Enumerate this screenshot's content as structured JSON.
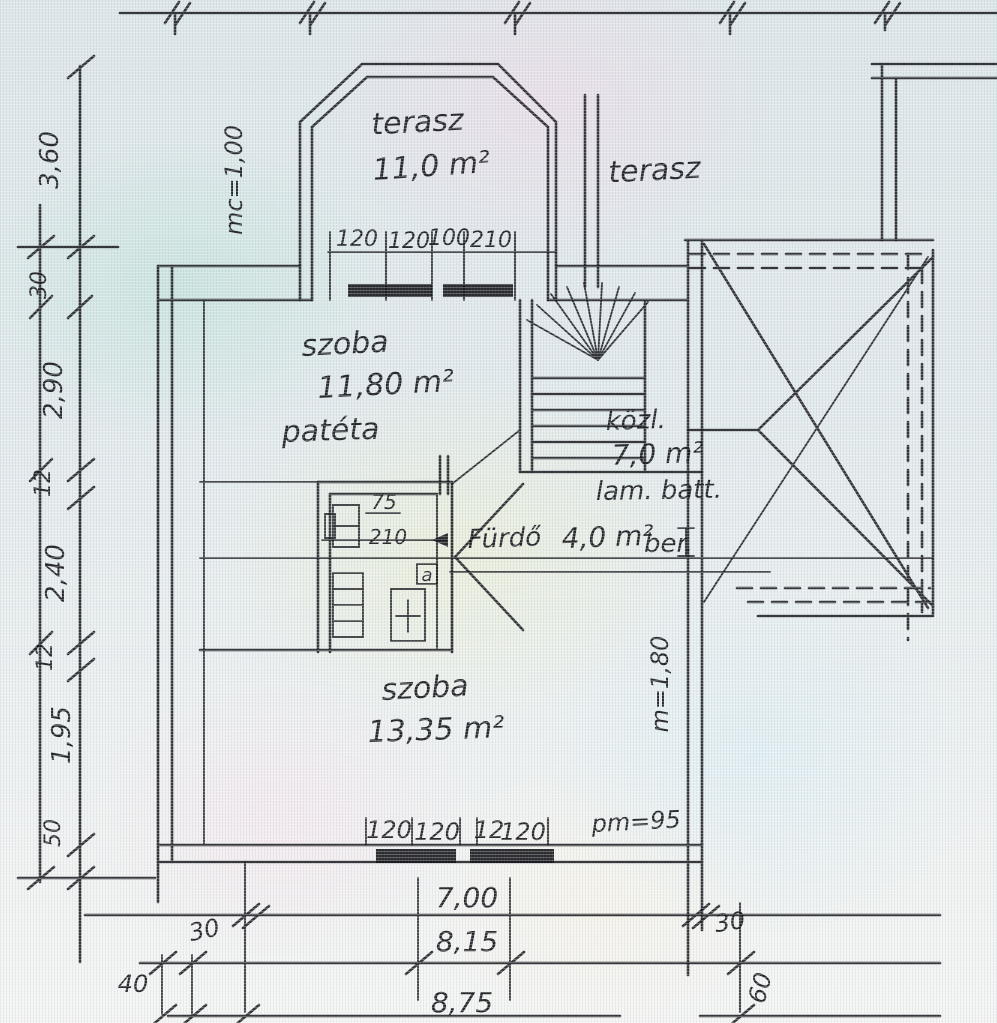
{
  "labels": {
    "terasz_bay": "terasz",
    "terasz_bay_area": "11,0 m²",
    "terasz_right": "terasz",
    "szoba1": "szoba",
    "szoba1_area": "11,80 m²",
    "szoba1_note": "patéta",
    "kozl": "közl.",
    "kozl_area": "7,0 m²",
    "lam_batt": "lam. batt.",
    "furdo": "Fürdő",
    "furdo_area": "4,0 m²",
    "furdo_note": "ber.",
    "szoba2": "szoba",
    "szoba2_area": "13,35 m²"
  },
  "dims": {
    "left": [
      "3,60",
      "30",
      "2,90",
      "12",
      "2,40",
      "12",
      "1,95",
      "50"
    ],
    "top_row": [
      "120",
      "120",
      "100",
      "210"
    ],
    "bottom_row": [
      "120",
      "120",
      "12",
      "120"
    ],
    "parapet": "pm=95",
    "total_1": "7,00",
    "total_2": "8,15",
    "total_3": "8,75",
    "offset_left": "30",
    "offset_right": "30",
    "corner_left": "40",
    "corner_right": "60",
    "height_left": "mc=1,00",
    "height_right": "m=1,80",
    "bath_width": "75",
    "bath_len": "210",
    "door": "a"
  },
  "colors": {
    "ink": "#1b1b20",
    "paper": "#e2e9ec"
  }
}
